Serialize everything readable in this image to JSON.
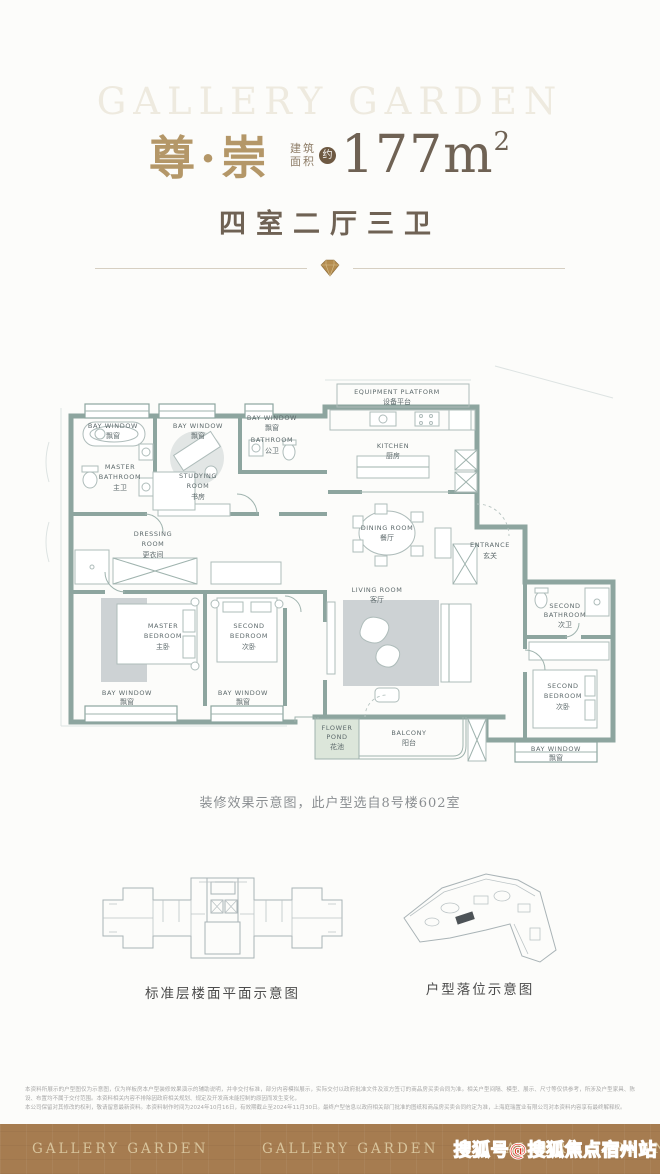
{
  "header": {
    "watermark": "GALLERY GARDEN",
    "title": "尊·崇",
    "area_label_top": "建筑",
    "area_label_bottom": "面积",
    "area_approx_badge": "约",
    "area_value": "177m",
    "area_superscript": "2",
    "room_summary": "四室二厅三卫"
  },
  "floorplan": {
    "labels": {
      "bay_window": {
        "en": "BAY WINDOW",
        "cn": "飘窗"
      },
      "master_bathroom": {
        "en1": "MASTER",
        "en2": "BATHROOM",
        "cn": "主卫"
      },
      "studying_room": {
        "en1": "STUDYING",
        "en2": "ROOM",
        "cn": "书房"
      },
      "bathroom": {
        "en": "BATHROOM",
        "cn": "公卫"
      },
      "equipment_platform": {
        "en": "EQUIPMENT PLATFORM",
        "cn": "设备平台"
      },
      "kitchen": {
        "en": "KITCHEN",
        "cn": "厨房"
      },
      "dining_room": {
        "en": "DINING ROOM",
        "cn": "餐厅"
      },
      "entrance": {
        "en": "ENTRANCE",
        "cn": "玄关"
      },
      "dressing_room": {
        "en1": "DRESSING",
        "en2": "ROOM",
        "cn": "更衣间"
      },
      "master_bedroom": {
        "en1": "MASTER",
        "en2": "BEDROOM",
        "cn": "主卧"
      },
      "second_bedroom": {
        "en1": "SECOND",
        "en2": "BEDROOM",
        "cn": "次卧"
      },
      "living_room": {
        "en": "LIVING ROOM",
        "cn": "客厅"
      },
      "second_bathroom": {
        "en1": "SECOND",
        "en2": "BATHROOM",
        "cn": "次卫"
      },
      "balcony": {
        "en": "BALCONY",
        "cn": "阳台"
      },
      "flower_pond": {
        "en1": "FLOWER",
        "en2": "POND",
        "cn": "花池"
      }
    }
  },
  "captions": {
    "note": "装修效果示意图，此户型选自8号楼602室",
    "floor_plate": "标准层楼面平面示意图",
    "site_location": "户型落位示意图"
  },
  "disclaimer": {
    "line1": "本资料所展示的户型图仅为示意图，仅为样板房本户型装修效果演示的辅助说明，并非交付标准，部分内容模拟展示，实际交付以政府批准文件及双方签订的商品房买卖合同为准。相关户型间隔、模型、展示、尺寸等仅供参考，所涉及户型家具、陈设、布置均不属于交付范围。本资料相关内容不排除因政府相关规划、规定及开发商未能控制的原因而发生变化，",
    "line2": "本公司保留对其修改的权利，敬请留意最新资料。本资料制作时间为2024年10月16日，有效期截止至2024年11月30日。最终户型信息以政府相关部门批准的图纸和商品房买卖合同约定为准，上海庭瑞置业有限公司对本资料内容享有最终解释权。"
  },
  "footer": {
    "logo": "GALLERY GARDEN",
    "sohu_watermark": "搜狐号@搜狐焦点宿州站"
  },
  "colors": {
    "gold_title": "#b49768",
    "dark_taupe": "#6f6254",
    "wall": "#8da59f",
    "band": "#a67c50",
    "band_text": "#d8c49c",
    "sohu_red": "#e61d0c"
  }
}
